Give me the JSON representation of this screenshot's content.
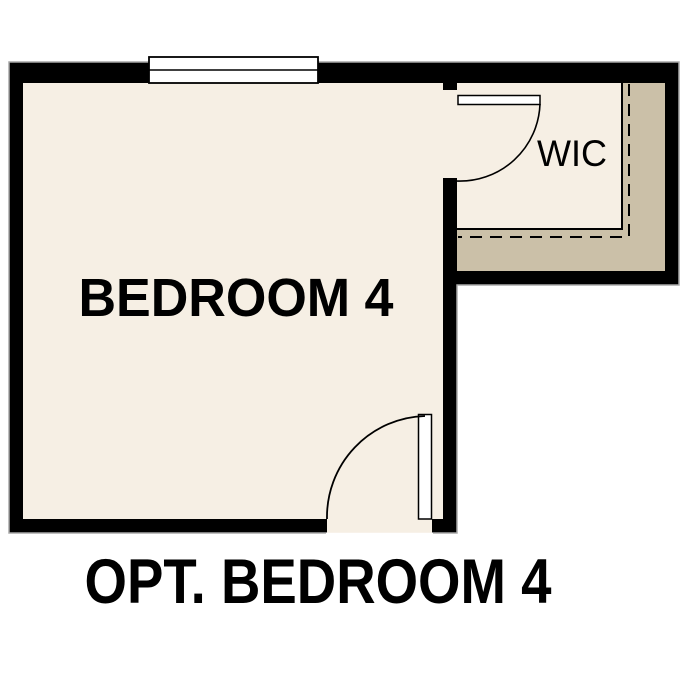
{
  "plan": {
    "bedroom_label": "BEDROOM 4",
    "closet_label": "WIC",
    "caption": "OPT. BEDROOM 4"
  },
  "colors": {
    "wall": "#000000",
    "floor": "#f6efe4",
    "closet_shelf": "#cbc0a8",
    "edge_outline": "#a9a9a9",
    "background": "#ffffff",
    "text": "#000000"
  }
}
